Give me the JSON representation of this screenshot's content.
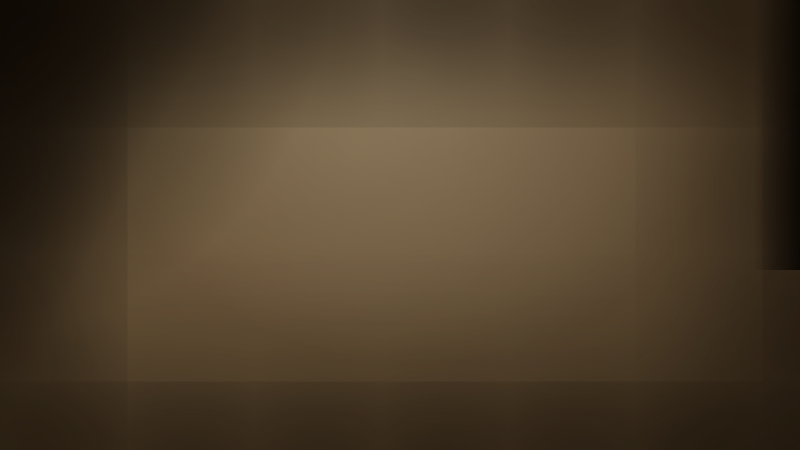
{
  "watermark": {
    "text": "Q房网",
    "positions": [
      [
        55,
        95
      ],
      [
        200,
        32
      ],
      [
        345,
        162
      ],
      [
        418,
        236
      ],
      [
        700,
        42
      ],
      [
        740,
        152
      ],
      [
        205,
        270
      ],
      [
        696,
        264
      ],
      [
        105,
        416
      ],
      [
        425,
        424
      ],
      [
        672,
        390
      ],
      [
        762,
        424
      ],
      [
        557,
        188
      ]
    ]
  },
  "map": {
    "labels": [
      {
        "t": "棕榈岛高尔夫球会",
        "x": 262,
        "y": 37,
        "c": "w",
        "fs": 8
      },
      {
        "t": "",
        "x": 257,
        "y": 51,
        "c": "w",
        "fs": 9,
        "icon": "ball",
        "ipos": "only"
      },
      {
        "t": "惠阳区政府",
        "x": 356,
        "y": 70,
        "c": "w",
        "fs": 8,
        "icon": "star",
        "ipos": "above"
      },
      {
        "t": "三和医院",
        "x": 311,
        "y": 98,
        "c": "w",
        "fs": 9,
        "icon": "cross"
      },
      {
        "t": "惠州南站",
        "x": 449,
        "y": 39,
        "c": "plaque",
        "fs": 7
      },
      {
        "t": "",
        "x": 453,
        "y": 62,
        "c": "w",
        "fs": 11,
        "icon": "rail",
        "ipos": "only"
      },
      {
        "t": "惠阳汽车总站",
        "x": 424,
        "y": 61,
        "c": "w",
        "fs": 5
      },
      {
        "t": "城市公园",
        "x": 487,
        "y": 70,
        "c": "pilllight",
        "fs": 6
      },
      {
        "t": "惠阳区人民医院",
        "x": 433,
        "y": 106,
        "c": "w",
        "fs": 6,
        "icon": "cross"
      },
      {
        "t": "比亚迪工业园",
        "x": 489,
        "y": 131,
        "c": "blue",
        "fs": 7,
        "icon": "oval",
        "ipos": "above"
      },
      {
        "t": "深圳新能源汽车基地",
        "x": 178,
        "y": 160,
        "c": "w",
        "fs": 9
      },
      {
        "t": "深圳出口加工区",
        "x": 77,
        "y": 252,
        "c": "w",
        "fs": 10,
        "icon": "dot",
        "ipos": "right"
      },
      {
        "t": "深圳坪山站",
        "x": 45,
        "y": 338,
        "c": "w",
        "fs": 11,
        "icon": "rail",
        "ipos": "above"
      },
      {
        "t": "坪山围",
        "x": 203,
        "y": 182,
        "c": "w",
        "fs": 5
      },
      {
        "t": "铁炉嶂",
        "x": 666,
        "y": 55,
        "c": "w",
        "fs": 9,
        "icon": "peak",
        "ipos": "above"
      },
      {
        "t": "风田水库",
        "x": 613,
        "y": 170,
        "c": "w",
        "fs": 8
      },
      {
        "t": "华美达酒店",
        "x": 474,
        "y": 167,
        "c": "w",
        "fs": 8,
        "icon": "building"
      },
      {
        "t": "大亚湾中心医院",
        "x": 591,
        "y": 215,
        "c": "w",
        "fs": 6,
        "icon": "cross"
      },
      {
        "t": "大亚湾中心客运站",
        "x": 561,
        "y": 241,
        "c": "w",
        "fs": 8,
        "icon": "bus"
      },
      {
        "t": "文化体育中心",
        "x": 606,
        "y": 271,
        "c": "w",
        "fs": 7,
        "icon": "book"
      },
      {
        "t": "大亚湾规划局",
        "x": 611,
        "y": 289,
        "c": "w",
        "fs": 7,
        "icon": "star"
      },
      {
        "t": "大亚湾·国税局",
        "x": 661,
        "y": 289,
        "c": "w",
        "fs": 7
      },
      {
        "t": "狮头岭",
        "x": 453,
        "y": 311,
        "c": "w",
        "fs": 9,
        "icon": "mount"
      },
      {
        "t": "燕子尾",
        "x": 454,
        "y": 358,
        "c": "w",
        "fs": 9,
        "icon": "mount"
      },
      {
        "t": "泡泡海",
        "x": 719,
        "y": 239,
        "c": "w",
        "fs": 9,
        "icon": "boat",
        "ipos": "above"
      },
      {
        "t": "惠州港",
        "x": 732,
        "y": 367,
        "c": "sea",
        "fs": 13
      },
      {
        "t": "",
        "x": 674,
        "y": 357,
        "c": "w",
        "fs": 12,
        "icon": "anchor",
        "ipos": "only"
      },
      {
        "t": "滨海度假走廊",
        "x": 680,
        "y": 419,
        "c": "sea",
        "fs": 10
      },
      {
        "t": "大亚湾儿童公园",
        "x": 400,
        "y": 220,
        "c": "green",
        "fs": 7,
        "icon": "tree",
        "ipos": "above"
      },
      {
        "t": "笔架岭郊野公园",
        "x": 421,
        "y": 269,
        "c": "green",
        "fs": 9,
        "icon": "tree"
      },
      {
        "t": "红树林公园",
        "x": 631,
        "y": 313,
        "c": "green",
        "fs": 9,
        "icon": "tree"
      },
      {
        "t": "滨海公园",
        "x": 570,
        "y": 367,
        "c": "green",
        "fs": 9,
        "icon": "tree",
        "ipos": "right"
      },
      {
        "t": "世纪城商业中心",
        "x": 416,
        "y": 287,
        "c": "red",
        "fs": 8,
        "icon": "badge"
      },
      {
        "t": "大型商业综合体",
        "x": 433,
        "y": 332,
        "c": "red",
        "fs": 8,
        "icon": "badge"
      },
      {
        "t": "世纪购物广场",
        "x": 380,
        "y": 343,
        "c": "darkred",
        "fs": 7
      },
      {
        "t": "大亚湾",
        "x": 521,
        "y": 340,
        "c": "blue",
        "fs": 7,
        "icon": "cap",
        "ipos": "above"
      },
      {
        "t": "第一中学",
        "x": 523,
        "y": 350,
        "c": "blue",
        "fs": 7
      },
      {
        "t": "澳头中心",
        "x": 573,
        "y": 342,
        "c": "magenta",
        "fs": 6,
        "w": 26
      },
      {
        "t": "御海湾",
        "x": 389,
        "y": 232,
        "c": "pink",
        "fs": 9,
        "icon": "flower"
      },
      {
        "t": "御海湾二期",
        "x": 434,
        "y": 123,
        "c": "pink",
        "fs": 6,
        "icon": "flower"
      }
    ],
    "road_signs": [
      {
        "t": "沈海高速G15",
        "x": 226,
        "y": 121,
        "rot": -28,
        "k": "hwyflat"
      },
      {
        "t": "惠大高速",
        "x": 521,
        "y": 131,
        "vert": true,
        "k": "hwy"
      },
      {
        "t": "白云大道",
        "x": 402,
        "y": 77,
        "vert": true,
        "k": "rd"
      },
      {
        "t": "龙海二路",
        "x": 364,
        "y": 196,
        "rot": -10,
        "k": "rd"
      },
      {
        "t": "石化大道西",
        "x": 477,
        "y": 257,
        "rot": -10,
        "k": "rd"
      },
      {
        "t": "中兴中路",
        "x": 511,
        "y": 234,
        "vert": true,
        "k": "rd"
      },
      {
        "t": "龙山五路",
        "x": 344,
        "y": 275,
        "vert": true,
        "k": "rd"
      },
      {
        "t": "深汕大道",
        "x": 157,
        "y": 293,
        "vert": true,
        "k": "rd"
      },
      {
        "t": "兰竹西路",
        "x": 231,
        "y": 314,
        "vert": true,
        "k": "rd"
      },
      {
        "t": "坪葵路",
        "x": 203,
        "y": 267,
        "rot": -24,
        "k": "rd"
      },
      {
        "t": "西区大道",
        "x": 268,
        "y": 214,
        "vert": true,
        "k": "rd"
      }
    ],
    "colors": {
      "road": "#ece4cf",
      "ringDash": "#ff5f4d",
      "metroGreen": "#3ed47c",
      "metroRed": "#e85848",
      "sea": "#0d1b28",
      "reservoir": "#274a6d",
      "hill": "#3c4a2e",
      "park": "#8a8a58",
      "label_green": "#4fd47f"
    }
  }
}
